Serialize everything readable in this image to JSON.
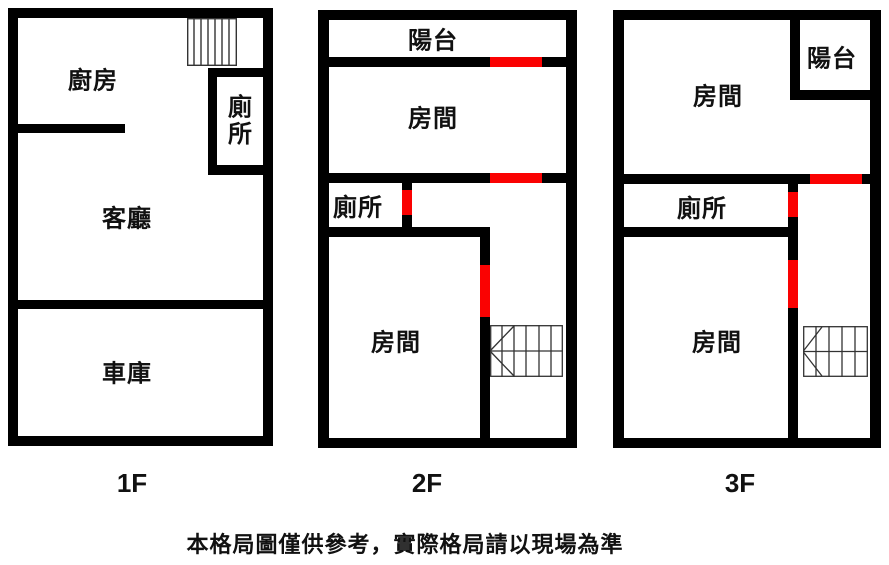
{
  "colors": {
    "wall": "#000000",
    "door": "#fa0202"
  },
  "floors": [
    {
      "label": "1F",
      "rooms": {
        "kitchen": "廚房",
        "toilet": "廁所",
        "living_room": "客廳",
        "garage": "車庫"
      }
    },
    {
      "label": "2F",
      "rooms": {
        "balcony": "陽台",
        "room_top": "房間",
        "toilet": "廁所",
        "room_bottom": "房間"
      }
    },
    {
      "label": "3F",
      "rooms": {
        "room_top": "房間",
        "balcony": "陽台",
        "toilet": "廁所",
        "room_bottom": "房間"
      }
    }
  ],
  "disclaimer": "本格局圖僅供參考，實際格局請以現場為準"
}
